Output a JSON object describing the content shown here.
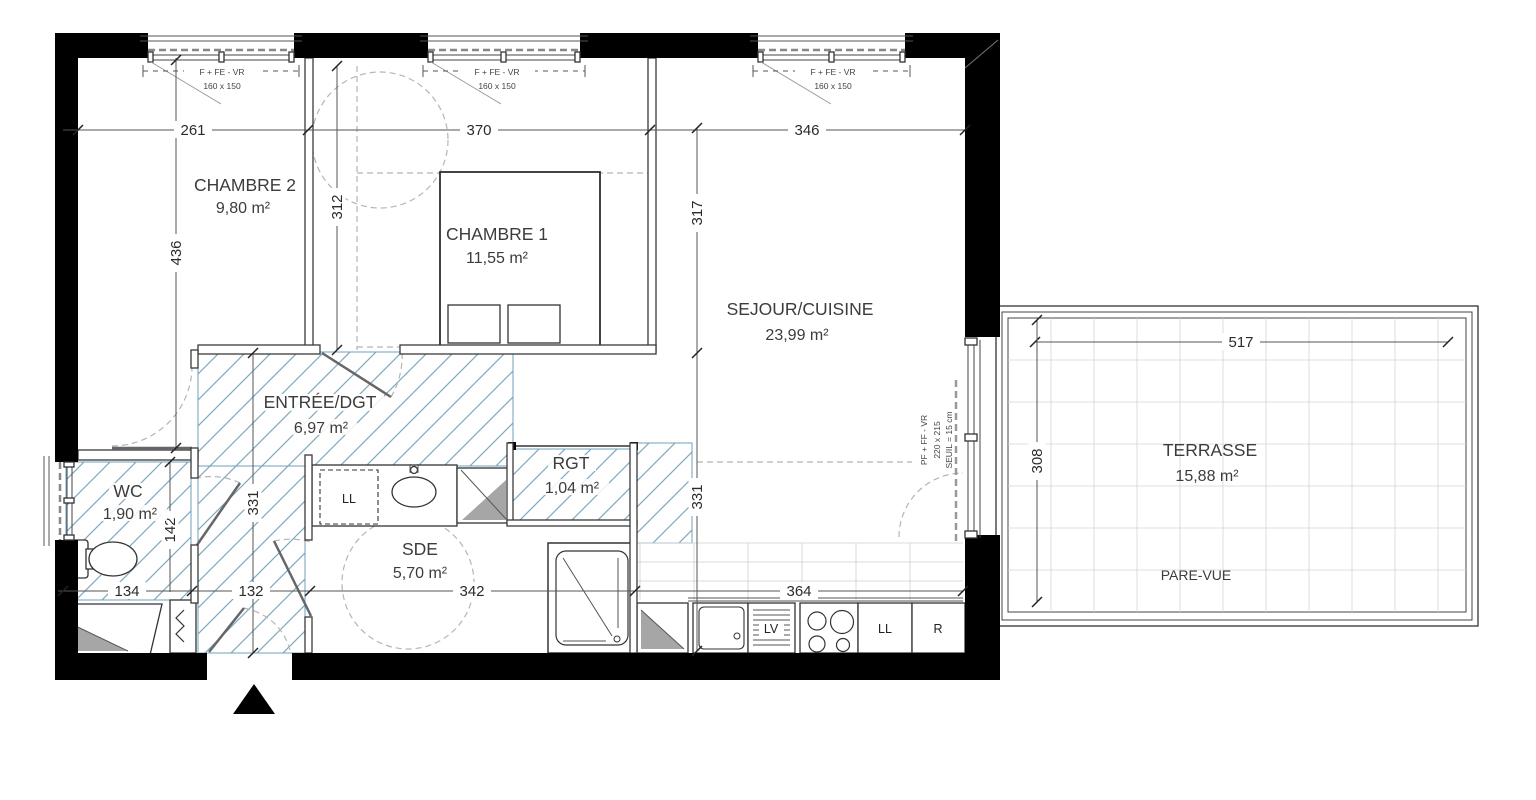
{
  "plan": {
    "rooms": {
      "chambre2": {
        "name": "CHAMBRE 2",
        "area": "9,80 m²"
      },
      "chambre1": {
        "name": "CHAMBRE 1",
        "area": "11,55 m²"
      },
      "sejour_cuisine": {
        "name": "SEJOUR/CUISINE",
        "area": "23,99 m²"
      },
      "entree_dgt": {
        "name": "ENTRÉE/DGT",
        "area": "6,97 m²"
      },
      "wc": {
        "name": "WC",
        "area": "1,90 m²"
      },
      "rgt": {
        "name": "RGT",
        "area": "1,04 m²"
      },
      "sde": {
        "name": "SDE",
        "area": "5,70 m²"
      },
      "terrasse": {
        "name": "TERRASSE",
        "area": "15,88 m²"
      }
    },
    "annotations": {
      "pare_vue": "PARE-VUE"
    },
    "window_label": {
      "type": "F + FE - VR",
      "size": "160 x 150"
    },
    "terrace_door_label": {
      "type": "PF + FF - VR",
      "size": "220 x 215",
      "seuil": "SEUIL = 15 cm"
    },
    "appliances": {
      "washer": "LL",
      "dishwasher": "LV",
      "fridge": "R"
    },
    "dimensions": {
      "chambre2_width": "261",
      "chambre1_width": "370",
      "sejour_width": "346",
      "chambre2_height": "436",
      "chambre1_height": "312",
      "sejour_height": "317",
      "hall_height_left": "331",
      "hall_height_right": "331",
      "wc_height": "142",
      "wc_width": "134",
      "entry_width": "132",
      "sde_width": "342",
      "kitchen_width": "364",
      "terrasse_width": "517",
      "terrasse_height": "308"
    },
    "colors": {
      "wall": "#000000",
      "hatch": "#7FA8BE",
      "grid": "#cfcfcf",
      "text": "#3c3c3c"
    }
  }
}
